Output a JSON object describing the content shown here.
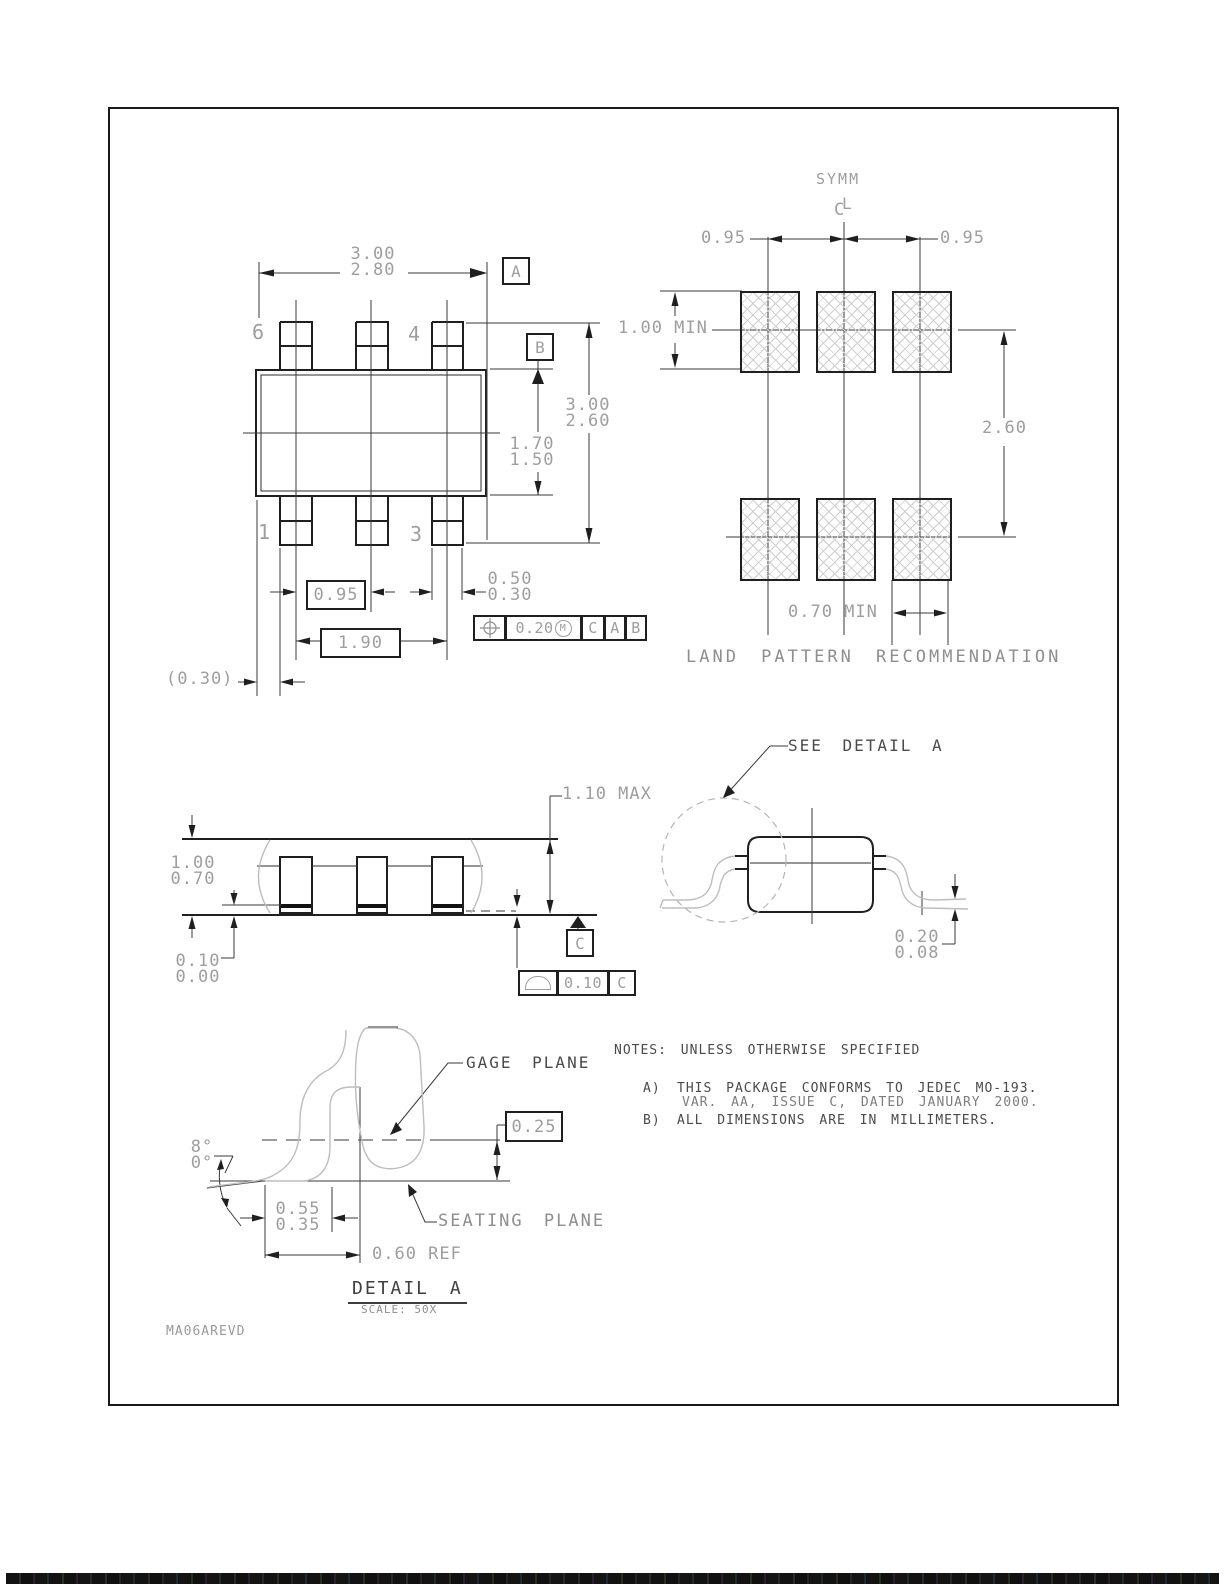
{
  "page": {
    "footer_code": "MA06AREVD"
  },
  "top_view": {
    "dim_width": {
      "max": "3.00",
      "min": "2.80"
    },
    "datum_a": "A",
    "datum_b": "B",
    "pins": {
      "p6": "6",
      "p4": "4",
      "p1": "1",
      "p3": "3"
    },
    "dim_body_height": {
      "max": "1.70",
      "min": "1.50"
    },
    "dim_overall_height": {
      "max": "3.00",
      "min": "2.60"
    },
    "dim_pitch": "0.95",
    "dim_lead_width": {
      "max": "0.50",
      "min": "0.30"
    },
    "dim_span": "1.90",
    "fcf_position": {
      "tol": "0.20",
      "modifier": "M",
      "d1": "C",
      "d2": "A",
      "d3": "B"
    },
    "dim_edge_ref": "(0.30)"
  },
  "land_pattern": {
    "symm_label": "SYMM",
    "centerline": {
      "c": "C",
      "l": "L"
    },
    "dim_pitch_left": "0.95",
    "dim_pitch_right": "0.95",
    "dim_pad_height": "1.00 MIN",
    "dim_row_span": "2.60",
    "dim_pad_width": "0.70 MIN",
    "title": "LAND PATTERN RECOMMENDATION"
  },
  "side_view": {
    "dim_height": "1.10 MAX",
    "dim_body": {
      "max": "1.00",
      "min": "0.70"
    },
    "dim_standoff": {
      "max": "0.10",
      "min": "0.00"
    },
    "datum_c": "C",
    "fcf_flatness": {
      "tol": "0.10",
      "datum": "C"
    }
  },
  "detail_callout": {
    "label": "SEE DETAIL A",
    "dim_lead_thickness": {
      "max": "0.20",
      "min": "0.08"
    }
  },
  "detail_a": {
    "gage_plane": "GAGE PLANE",
    "seating_plane": "SEATING PLANE",
    "dim_gage_offset": "0.25",
    "angle": {
      "max": "8°",
      "min": "0°"
    },
    "dim_foot_length": {
      "max": "0.55",
      "min": "0.35"
    },
    "dim_ref": "0.60 REF",
    "title": "DETAIL A",
    "scale": "SCALE: 50X"
  },
  "notes": {
    "header": "NOTES: UNLESS OTHERWISE SPECIFIED",
    "a_label": "A)",
    "a_line1": "THIS PACKAGE CONFORMS TO JEDEC MO-193.",
    "a_line2": "VAR. AA, ISSUE C, DATED JANUARY 2000.",
    "b_label": "B)",
    "b_line1": "ALL DIMENSIONS ARE IN MILLIMETERS."
  }
}
